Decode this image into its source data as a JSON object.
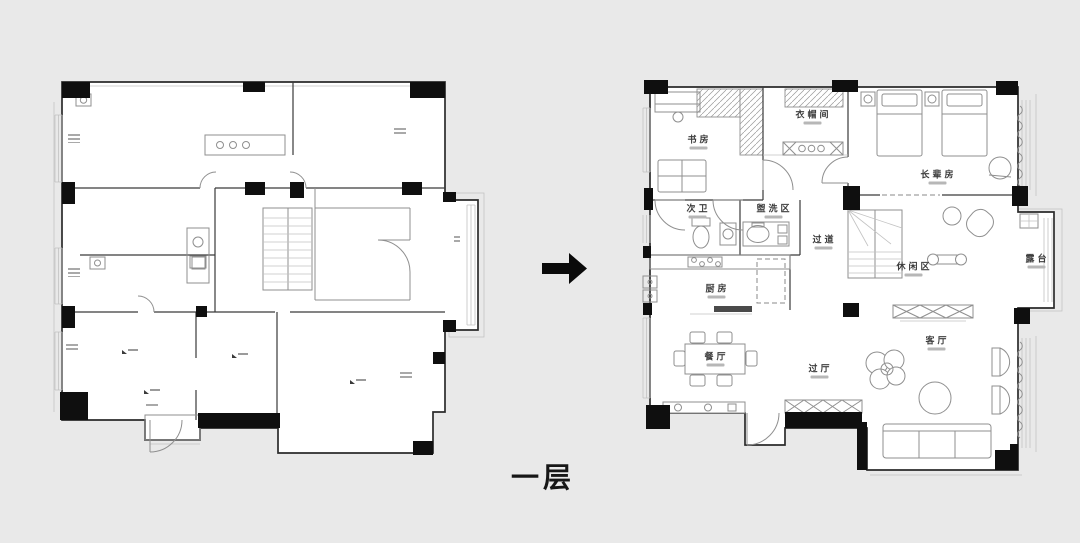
{
  "page": {
    "background_color": "#e9e9e9",
    "caption": "一层"
  },
  "colors": {
    "wall": "#2b2b2b",
    "column_fill": "#0f0f0f",
    "furniture_line": "#8f8f8f",
    "label_text": "#3c3c3c"
  },
  "arrow": {
    "icon": "right-arrow",
    "color": "#0a0a0a"
  },
  "plans": {
    "left": {
      "description_labels": []
    },
    "right": {
      "rooms": [
        {
          "label": "书房"
        },
        {
          "label": "衣帽间"
        },
        {
          "label": "长辈房"
        },
        {
          "label": "次卫"
        },
        {
          "label": "盥洗区"
        },
        {
          "label": "过道"
        },
        {
          "label": "休闲区"
        },
        {
          "label": "露台"
        },
        {
          "label": "厨房"
        },
        {
          "label": "餐厅"
        },
        {
          "label": "过厅"
        },
        {
          "label": "客厅"
        }
      ]
    }
  }
}
